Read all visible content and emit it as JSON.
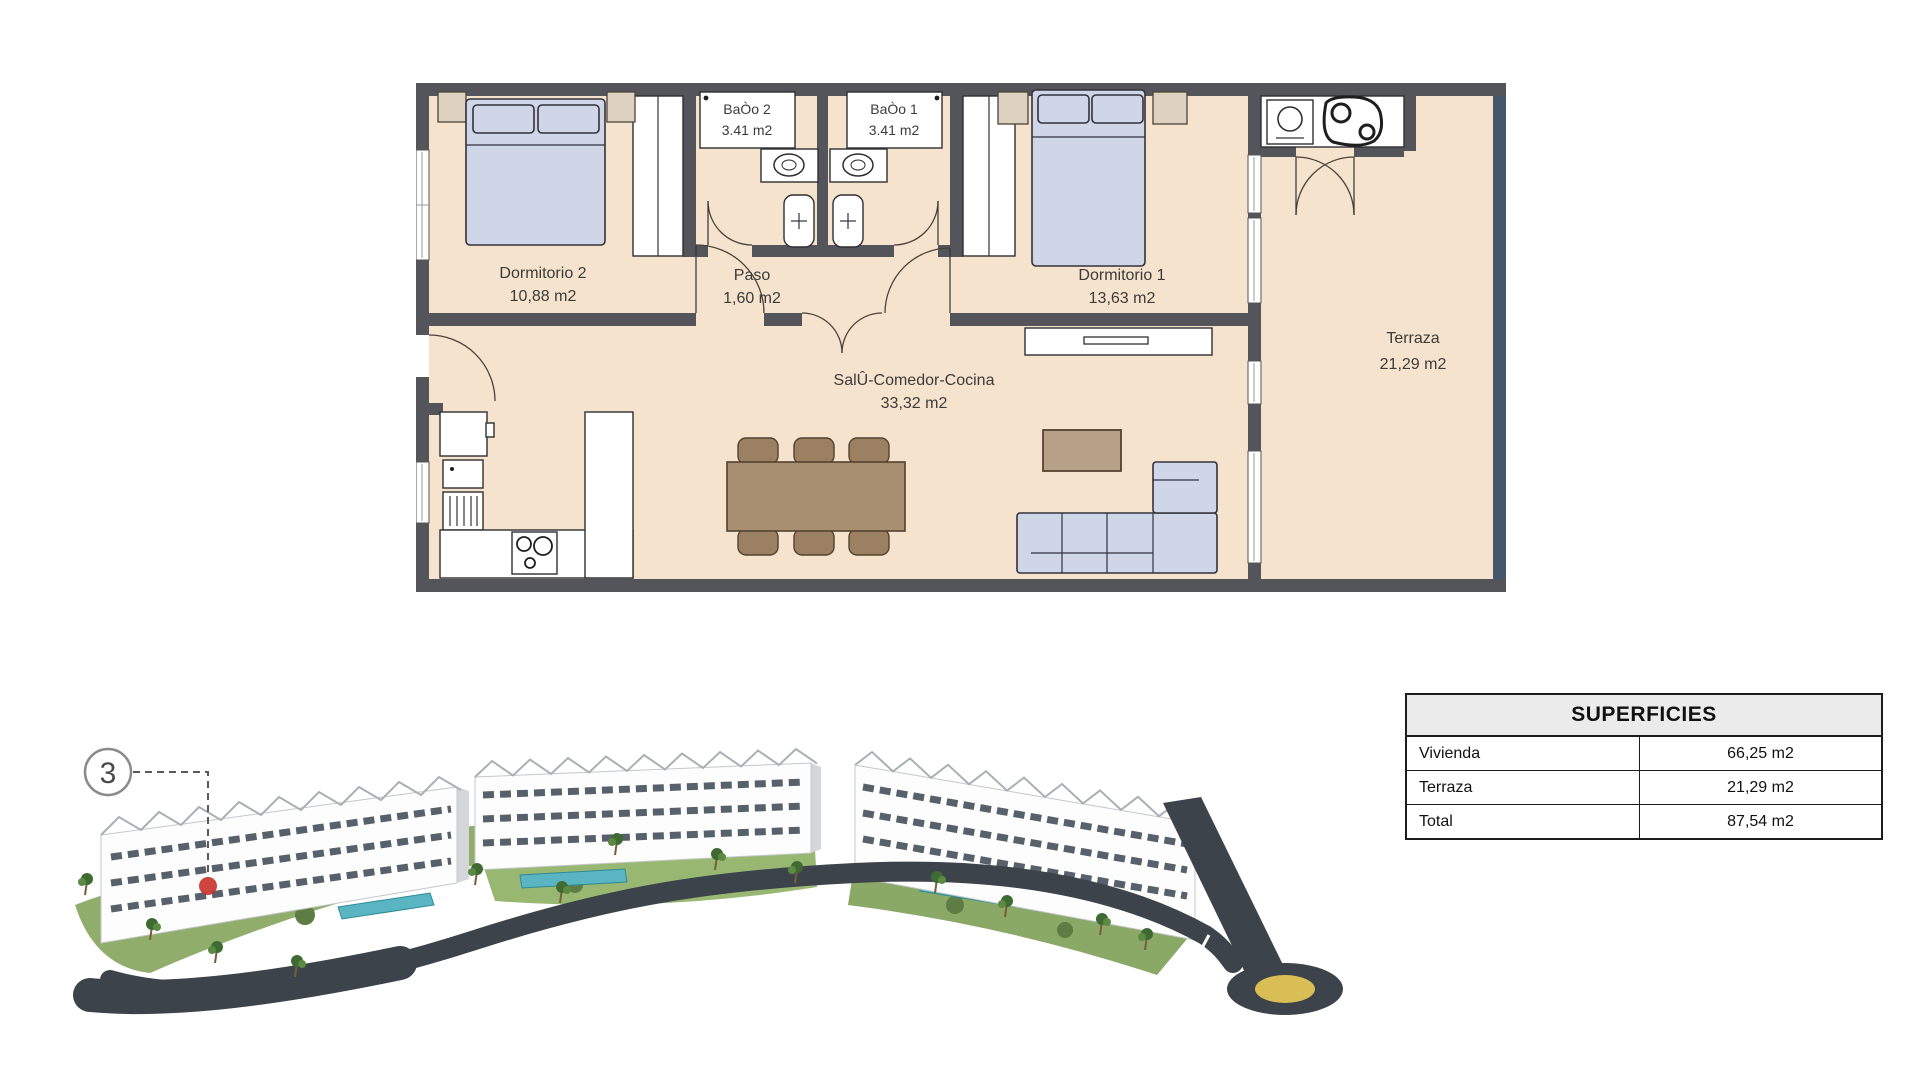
{
  "plan": {
    "rooms": {
      "dormitorio2": {
        "name": "Dormitorio 2",
        "area": "10,88 m2"
      },
      "paso": {
        "name": "Paso",
        "area": "1,60 m2"
      },
      "bano2": {
        "name": "BaÒo 2",
        "area": "3.41 m2"
      },
      "bano1": {
        "name": "BaÒo 1",
        "area": "3.41 m2"
      },
      "dormitorio1": {
        "name": "Dormitorio 1",
        "area": "13,63 m2"
      },
      "salon": {
        "name": "SalÛ-Comedor-Cocina",
        "area": "33,32 m2"
      },
      "terraza": {
        "name": "Terraza",
        "area": "21,29 m2"
      }
    }
  },
  "superficies_table": {
    "title": "SUPERFICIES",
    "rows": [
      {
        "label": "Vivienda",
        "value": "66,25 m2"
      },
      {
        "label": "Terraza",
        "value": "21,29 m2"
      },
      {
        "label": "Total",
        "value": "87,54 m2"
      }
    ]
  },
  "site": {
    "unit_marker": "3"
  },
  "colors": {
    "floor": "#f5e3cd",
    "wall": "#54555b",
    "balustrade": "#46566b",
    "furniture_blue": "#cfd6e8",
    "beige": "#ddd1bf",
    "wood": "#a98f72",
    "pool": "#5ab5c2",
    "road": "#3c434a",
    "roundabout_yellow": "#d9bd55",
    "marker_red": "#c9302a",
    "garden_green": "#84a45c"
  }
}
